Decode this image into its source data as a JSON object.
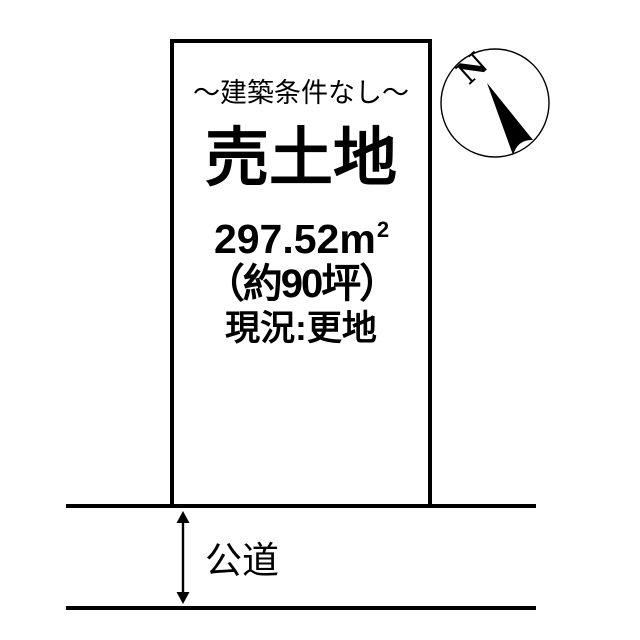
{
  "diagram": {
    "kind": "land-parcel-plan",
    "background_color": "#ffffff",
    "line_color": "#000000"
  },
  "parcel": {
    "condition_label": "～建築条件なし～",
    "title": "売土地",
    "area_value": "297.52",
    "area_unit": "m",
    "area_unit_exponent": "2",
    "area_tsubo": "（約90坪）",
    "status_label": "現況:更地"
  },
  "compass": {
    "north_label": "N"
  },
  "road": {
    "label": "公道"
  }
}
